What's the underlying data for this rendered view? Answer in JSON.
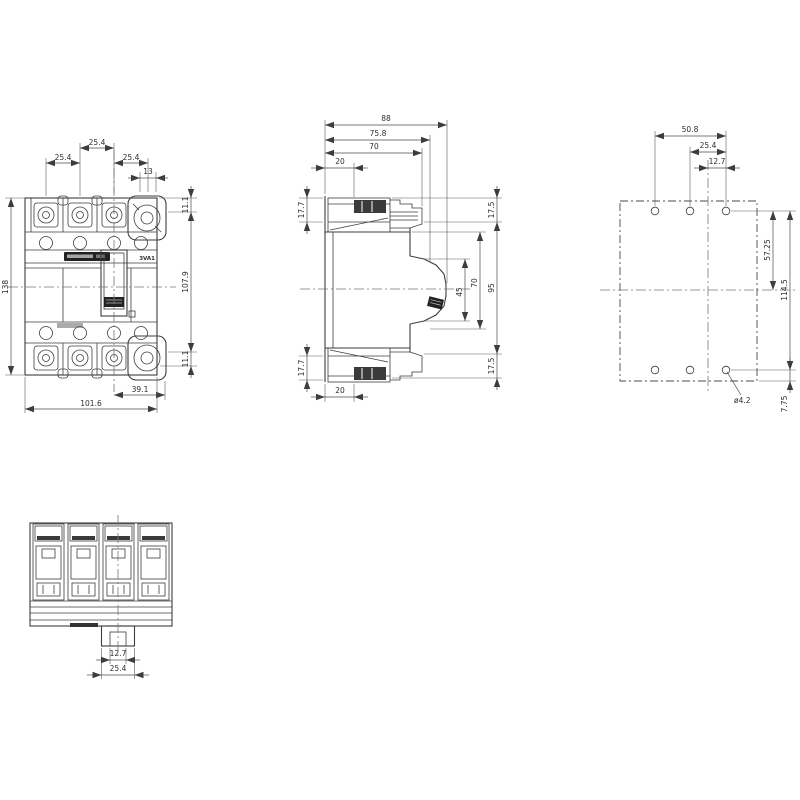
{
  "colors": {
    "ink": "#3d3d3d",
    "background": "#ffffff"
  },
  "front": {
    "type_label": "3VA1",
    "dim_pitch_left": "25.4",
    "dim_pitch_center": "25.4",
    "dim_pitch_right": "25.4",
    "dim_neutral_terminal": "13",
    "dim_overall_height": "138",
    "dim_terminal_offset_top": "11.1",
    "dim_terminal_span": "107.9",
    "dim_terminal_offset_bottom": "11.1",
    "dim_center_to_terminal": "39.1",
    "dim_overall_width": "101.6"
  },
  "side": {
    "dim_depth_overall": "88",
    "dim_depth_front": "75.8",
    "dim_depth_body": "70",
    "dim_terminal_depth_top": "20",
    "dim_terminal_height_top": "17.7",
    "dim_terminal_height_bottom": "17.7",
    "dim_terminal_depth_bottom": "20",
    "dim_offset_top": "17.5",
    "dim_mounting_height": "95",
    "dim_handle_clearance": "70",
    "dim_handle_height": "45",
    "dim_offset_bottom": "17.5"
  },
  "rear": {
    "dim_hole_span_h": "50.8",
    "dim_hole_pitch": "25.4",
    "dim_hole_to_center": "12.7",
    "dim_hole_to_centerline_v": "57.25",
    "dim_hole_span_v": "114.5",
    "dim_hole_edge_offset": "7.75",
    "hole_diameter_callout": "ø4.2"
  },
  "bottom": {
    "dim_rail_slot": "12.7",
    "dim_rail_clip": "25.4"
  }
}
